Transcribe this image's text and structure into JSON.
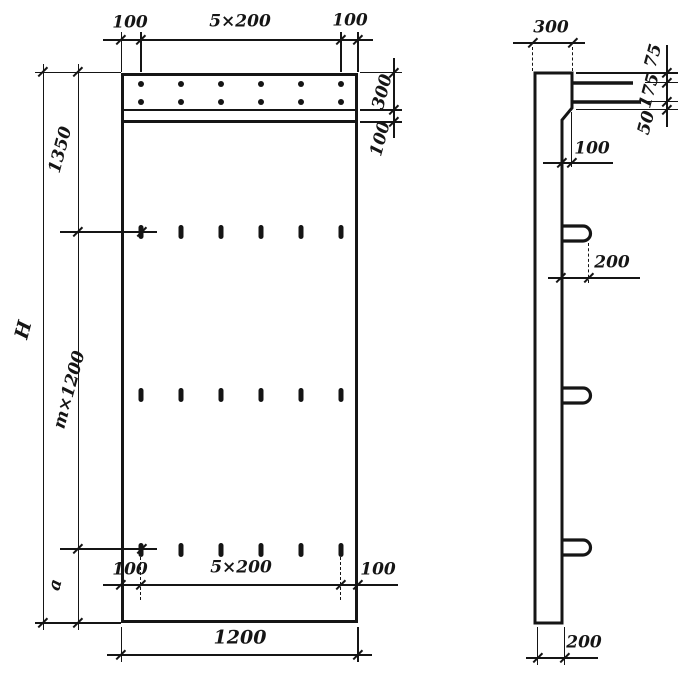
{
  "colors": {
    "ink": "#151515",
    "paper": "#ffffff"
  },
  "front_view": {
    "top": {
      "left": "100",
      "span": "5×200",
      "right": "100"
    },
    "right": {
      "band": "300",
      "sub_band": "100"
    },
    "left": {
      "upper": "1350",
      "middle": "m×1200",
      "lower": "a",
      "total": "H"
    },
    "bottom_inner": {
      "left": "100",
      "span": "5×200",
      "right": "100"
    },
    "bottom": {
      "width": "1200"
    }
  },
  "side_view": {
    "top": {
      "width": "300"
    },
    "joint": {
      "d1": "75",
      "d2": "175",
      "d3": "50"
    },
    "ledge": {
      "offset": "100"
    },
    "loop": {
      "protrusion": "200"
    },
    "bottom": {
      "thickness": "200"
    }
  }
}
